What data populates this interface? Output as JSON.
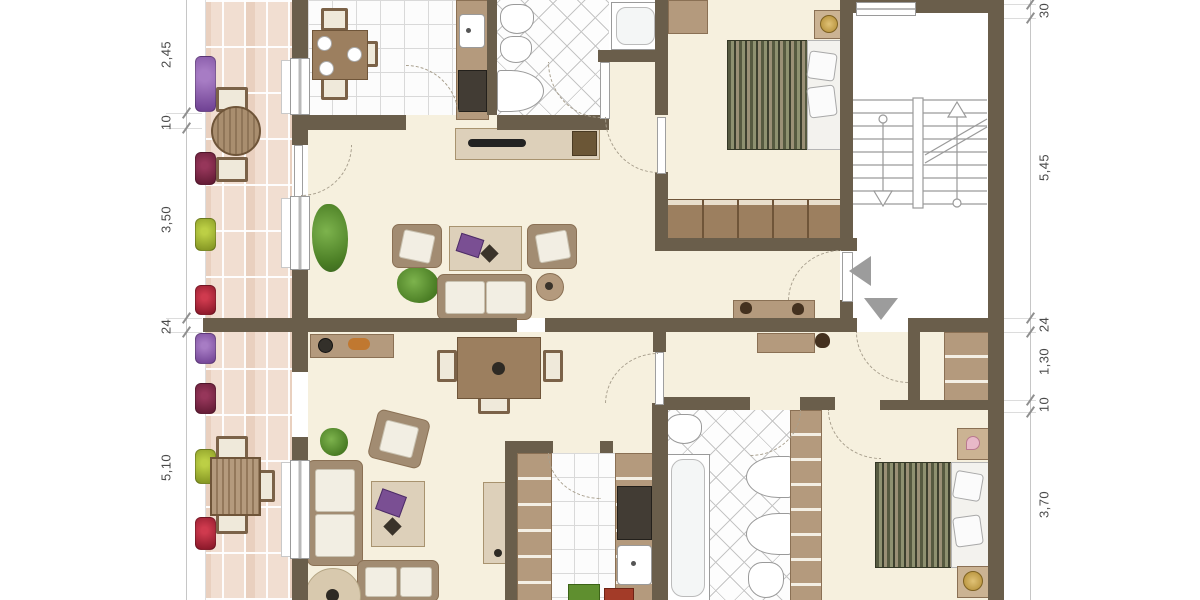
{
  "dimensions": {
    "left": [
      "2,45",
      "10",
      "3,50",
      "24",
      "5,10"
    ],
    "right": [
      "30",
      "5,45",
      "24",
      "1,30",
      "10",
      "3,70"
    ]
  },
  "markers": {
    "upper_entrance_arrow": "left-triangle",
    "lower_entrance_arrow": "down-triangle",
    "stair_direction_up": "up-arrow",
    "stair_direction_down": "down-arrow"
  },
  "colors": {
    "wall": "#6a5e4b",
    "floor_cream": "#f6f0de",
    "tile_white": "#fcfcfc",
    "terrace_brick": "#f1ded1",
    "wood_mid": "#b49a7d",
    "wood_dark": "#9c7f5f",
    "bed_olive_dark": "#3d402e",
    "bed_olive_light": "#8e9170",
    "marker_grey": "#9c9c9c",
    "flower_purple": "#8d5fae",
    "flower_red": "#b32438",
    "flower_dark_red": "#7c2342",
    "flower_yellow_green": "#a4b532"
  }
}
